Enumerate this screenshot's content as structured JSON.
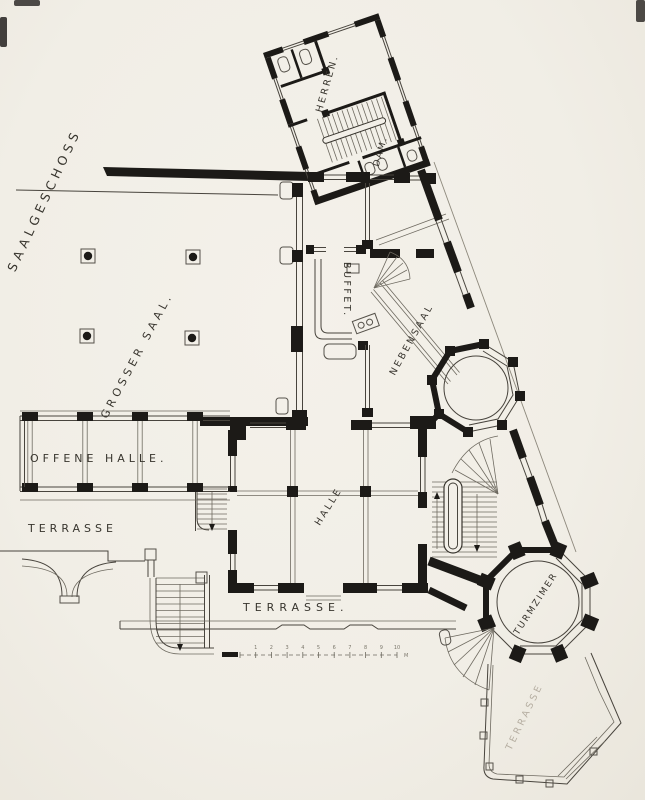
{
  "plan": {
    "floor_label": "SAALGESCHOSS",
    "rooms": {
      "grosser_saal": "GROSSER SAAL.",
      "herren": "HERREN.",
      "damen": "DAM.",
      "buffet": "BUFFET.",
      "nebensaal": "NEBENSAAL",
      "offene_halle": "OFFENE HALLE.",
      "halle": "HALLE",
      "turmzimmer": "TURMZIMER"
    },
    "outdoor": {
      "terrasse_west": "TERRASSE",
      "terrasse_south": "TERRASSE.",
      "terrasse_southeast": "TERRASSE"
    },
    "scale_bar": {
      "ticks": [
        "1",
        "2",
        "3",
        "4",
        "5",
        "6",
        "7",
        "8",
        "9",
        "10"
      ],
      "unit": "M"
    }
  },
  "colors": {
    "paper": "#f2efe8",
    "ink": "#1c1a17",
    "faint_text": "#b4ada0"
  }
}
